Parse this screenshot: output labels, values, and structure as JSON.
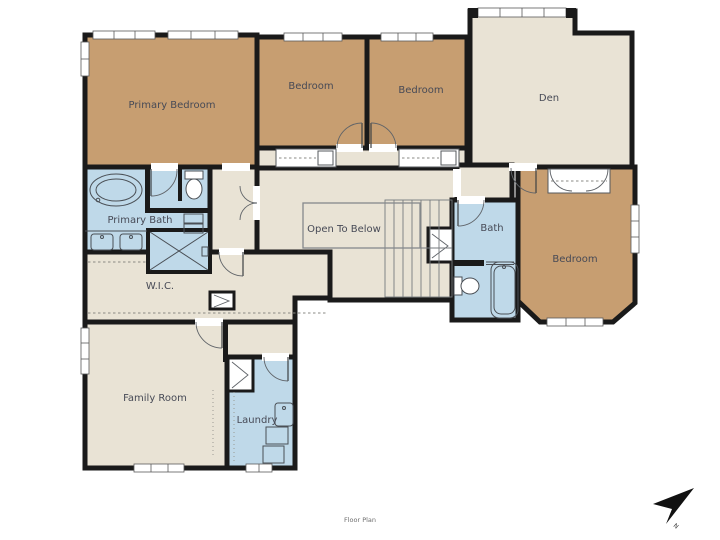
{
  "caption": "Floor Plan",
  "compass": {
    "label": "N"
  },
  "colors": {
    "bedroom_fill": "#c79e71",
    "common_fill": "#e9e3d5",
    "wet_fill": "#bfd9e9",
    "wall": "#1a1a1a",
    "label_text": "#474a56"
  },
  "rooms": {
    "primary_bedroom": "Primary Bedroom",
    "bedroom_top_left": "Bedroom",
    "bedroom_top_right": "Bedroom",
    "den": "Den",
    "primary_bath": "Primary Bath",
    "wic": "W.I.C.",
    "open_to_below": "Open To Below",
    "bath": "Bath",
    "bedroom_right": "Bedroom",
    "family_room": "Family Room",
    "laundry": "Laundry"
  }
}
